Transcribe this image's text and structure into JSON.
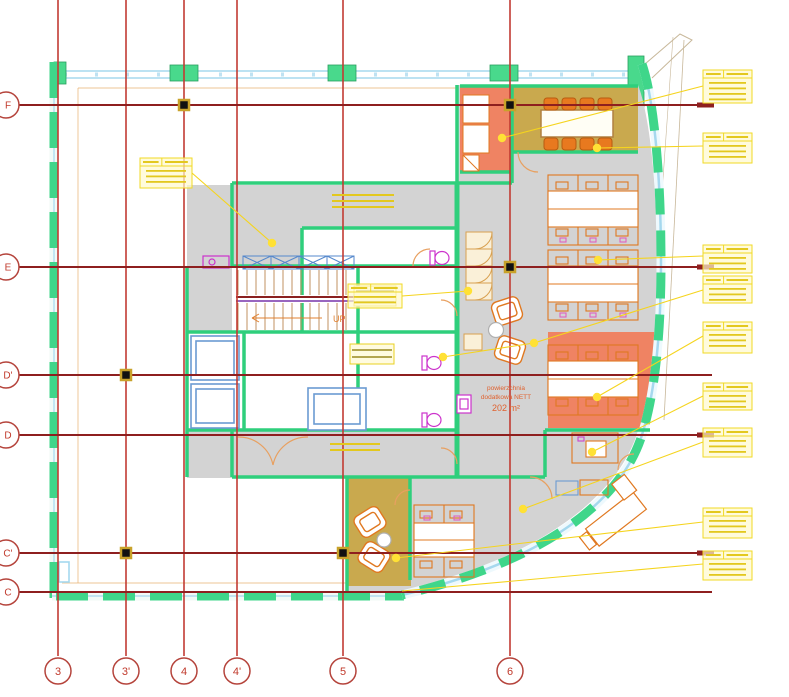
{
  "drawing": {
    "type": "architectural-floor-plan",
    "grid": {
      "columns": [
        {
          "label": "3",
          "x": 58
        },
        {
          "label": "3'",
          "x": 126
        },
        {
          "label": "4",
          "x": 184
        },
        {
          "label": "4'",
          "x": 237
        },
        {
          "label": "5",
          "x": 343
        },
        {
          "label": "6",
          "x": 510
        }
      ],
      "rows": [
        {
          "label": "F",
          "y": 105,
          "thick_end": true
        },
        {
          "label": "E",
          "y": 267,
          "thick_end": true
        },
        {
          "label": "D'",
          "y": 375,
          "thick_end": false
        },
        {
          "label": "D",
          "y": 435,
          "thick_end": true
        },
        {
          "label": "C'",
          "y": 553,
          "thick_end": true
        },
        {
          "label": "C",
          "y": 592,
          "thick_end": false
        }
      ],
      "column_line_top": 0,
      "column_line_bottom": 656,
      "row_line_left": 16,
      "row_line_right": 712,
      "column_bubble_y": 671,
      "row_bubble_x": 6,
      "bubble_radius": 13,
      "colors": {
        "column_line": "#c23b33",
        "row_line": "#8e1f1f",
        "bubble_stroke": "#b5443c",
        "label": "#c0392b"
      }
    },
    "column_markers": [
      [
        184,
        105
      ],
      [
        510,
        105
      ],
      [
        510,
        267
      ],
      [
        126,
        375
      ],
      [
        126,
        553
      ],
      [
        343,
        553
      ]
    ],
    "notes": {
      "area_label": {
        "lines": [
          "powierzchnia",
          "dodatkowa NETT",
          "202 m²"
        ],
        "x": 506,
        "y": 388,
        "color": "#e0622f"
      },
      "up_label": {
        "text": "UP",
        "x": 333,
        "y": 322,
        "color": "#e08030"
      }
    },
    "annotation_boxes": [
      {
        "x": 703,
        "y": 70,
        "w": 49,
        "h": 33,
        "n": 4,
        "border": true
      },
      {
        "x": 703,
        "y": 133,
        "w": 49,
        "h": 30,
        "n": 3,
        "border": true
      },
      {
        "x": 703,
        "y": 245,
        "w": 49,
        "h": 28,
        "n": 3,
        "border": true
      },
      {
        "x": 703,
        "y": 276,
        "w": 49,
        "h": 27,
        "n": 3,
        "border": true
      },
      {
        "x": 703,
        "y": 322,
        "w": 49,
        "h": 31,
        "n": 3,
        "border": true
      },
      {
        "x": 703,
        "y": 383,
        "w": 49,
        "h": 27,
        "n": 3,
        "border": true
      },
      {
        "x": 703,
        "y": 428,
        "w": 49,
        "h": 29,
        "n": 3,
        "border": true
      },
      {
        "x": 703,
        "y": 508,
        "w": 49,
        "h": 30,
        "n": 3,
        "border": true
      },
      {
        "x": 703,
        "y": 551,
        "w": 49,
        "h": 29,
        "n": 3,
        "border": true
      },
      {
        "x": 140,
        "y": 158,
        "w": 52,
        "h": 30,
        "n": 3,
        "border": true
      },
      {
        "x": 348,
        "y": 284,
        "w": 54,
        "h": 24,
        "n": 2,
        "border": true
      },
      {
        "x": 332,
        "y": 194,
        "w": 62,
        "h": 18,
        "n": 3,
        "border": false
      },
      {
        "x": 330,
        "y": 443,
        "w": 50,
        "h": 14,
        "n": 2,
        "border": false
      }
    ],
    "leader_dots": [
      [
        272,
        243
      ],
      [
        502,
        138
      ],
      [
        597,
        148
      ],
      [
        598,
        260
      ],
      [
        468,
        291
      ],
      [
        534,
        343
      ],
      [
        443,
        357
      ],
      [
        597,
        397
      ],
      [
        592,
        452
      ],
      [
        523,
        509
      ],
      [
        396,
        558
      ]
    ],
    "leader_lines": [
      [
        192,
        173,
        272,
        243
      ],
      [
        502,
        138,
        703,
        86
      ],
      [
        597,
        148,
        703,
        146
      ],
      [
        598,
        260,
        703,
        256
      ],
      [
        468,
        291,
        402,
        296
      ],
      [
        534,
        343,
        703,
        290
      ],
      [
        443,
        357,
        534,
        343
      ],
      [
        597,
        397,
        703,
        336
      ],
      [
        592,
        452,
        703,
        396
      ],
      [
        523,
        509,
        703,
        442
      ],
      [
        396,
        558,
        703,
        522
      ],
      [
        402,
        591,
        703,
        564
      ]
    ],
    "legend_colors": {
      "exterior_wall": "#2fcf7c",
      "window_band": "#a5d8ee",
      "floor": "#d3d3d3",
      "room_accent": "#ef8363",
      "room_meeting": "#c9a94e",
      "furniture": "#e07820",
      "annotation": "#f0d925",
      "fixture": "#cc33cc",
      "column_marker": "#111111"
    }
  }
}
